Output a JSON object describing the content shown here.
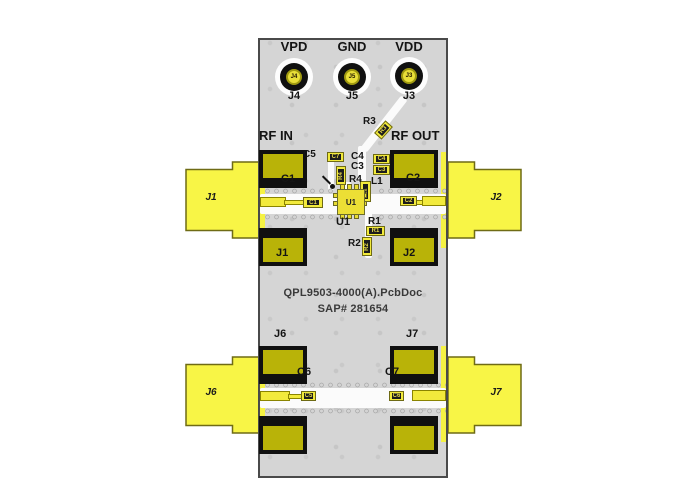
{
  "colors": {
    "board": "#d5d5d5",
    "board_border": "#4a4a4a",
    "connector_yellow": "#f8f546",
    "pad_olive": "#b9b308",
    "pad_black": "#101010",
    "trace_white": "#fbfbfb",
    "silk_text": "#141414"
  },
  "test_points": {
    "vpd": {
      "label": "VPD",
      "ref": "J4",
      "pad_marking": "J4"
    },
    "gnd": {
      "label": "GND",
      "ref": "J5",
      "pad_marking": "J5"
    },
    "vdd": {
      "label": "VDD",
      "ref": "J3",
      "pad_marking": "J3"
    }
  },
  "rf": {
    "in": "RF IN",
    "out": "RF OUT"
  },
  "connectors": {
    "j1": "J1",
    "j2": "J2",
    "j6": "J6",
    "j7": "J7"
  },
  "silkscreen": {
    "c1": "C1",
    "c2": "C2",
    "j1": "J1",
    "j2": "J2",
    "u1": "U1",
    "c3": "C3",
    "c4": "C4",
    "c5": "C5",
    "r1": "R1",
    "r2": "R2",
    "r3": "R3",
    "r4": "R4",
    "l1": "L1",
    "j6": "J6",
    "j7": "J7",
    "c6": "C6",
    "c7": "C7"
  },
  "part_markings": {
    "c1": "C1",
    "c2": "C2",
    "c3": "C3",
    "c4": "C4",
    "c5_part": "C7",
    "r1": "R1",
    "r2": "R2",
    "r3": "R3",
    "r4": "R4",
    "l1": "L1",
    "u1": "U1",
    "c6_part": "C5",
    "c7_part": "C6"
  },
  "board_text": {
    "line1": "QPL9503-4000(A).PcbDoc",
    "line2": "SAP# 281654"
  }
}
